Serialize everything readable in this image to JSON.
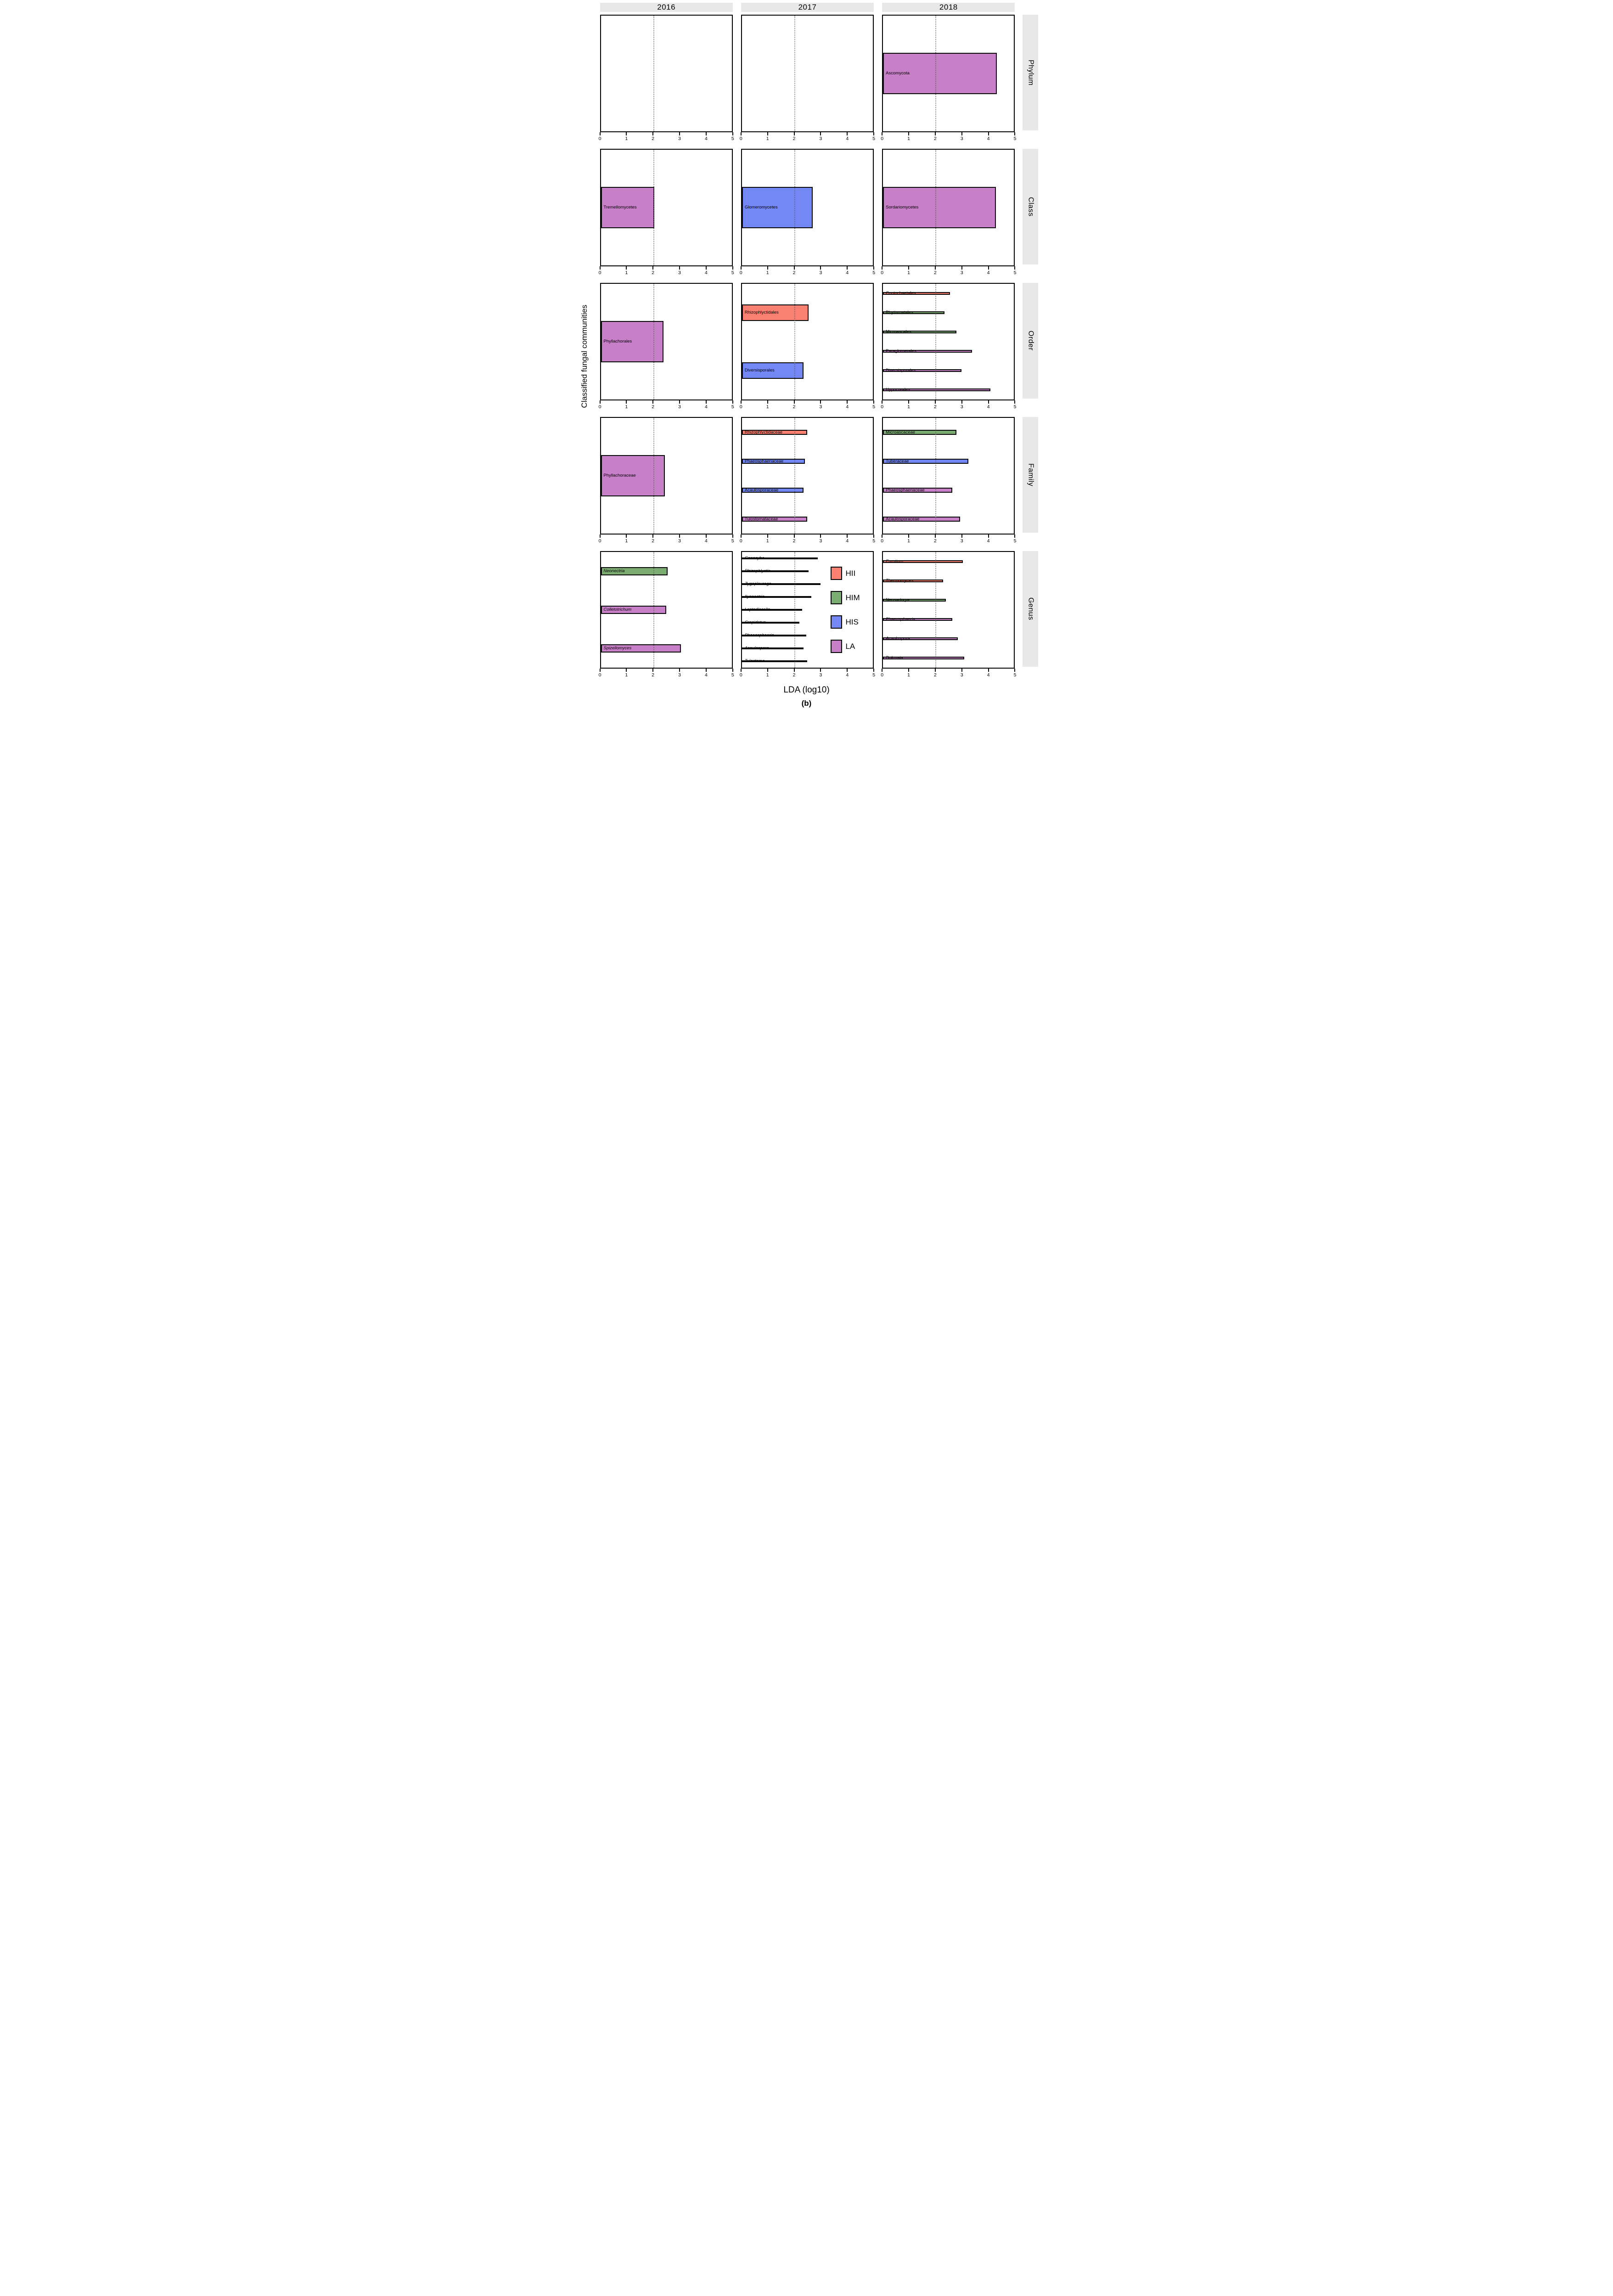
{
  "figure": {
    "xlabel": "LDA (log10)",
    "caption": "(b)",
    "ylabel": "Classified fungal communities"
  },
  "columns": [
    "2016",
    "2017",
    "2018"
  ],
  "rows": [
    "Phylum",
    "Class",
    "Order",
    "Family",
    "Genus"
  ],
  "legend": {
    "items": [
      {
        "label": "HII",
        "color": "#FA8072"
      },
      {
        "label": "HIM",
        "color": "#7BAC72"
      },
      {
        "label": "HIS",
        "color": "#7388F5"
      },
      {
        "label": "LA",
        "color": "#C77FC7"
      }
    ]
  },
  "group_colors": {
    "HII": "#FA8072",
    "HIM": "#7BAC72",
    "HIS": "#7388F5",
    "LA": "#C77FC7"
  },
  "chart_data": {
    "type": "bar",
    "orientation": "horizontal",
    "title": "",
    "xlabel": "LDA (log10)",
    "ylabel": "Classified fungal communities",
    "xlim": [
      0,
      5
    ],
    "xticks": [
      0,
      1,
      2,
      3,
      4,
      5
    ],
    "reference_line_x": 2,
    "grid": "dotted reference line at x=2 only",
    "legend_position": "inside Genus-2017 panel, right side",
    "facet_columns": [
      "2016",
      "2017",
      "2018"
    ],
    "facet_rows": [
      "Phylum",
      "Class",
      "Order",
      "Family",
      "Genus"
    ],
    "cells": [
      [
        [],
        [],
        [
          {
            "label": "Ascomycota",
            "group": "LA",
            "value": 4.35
          }
        ]
      ],
      [
        [
          {
            "label": "Tremellomycetes",
            "group": "LA",
            "value": 2.05
          }
        ],
        [
          {
            "label": "Glomeromycetes",
            "group": "HIS",
            "value": 2.7
          }
        ],
        [
          {
            "label": "Sordariomycetes",
            "group": "LA",
            "value": 4.3
          }
        ]
      ],
      [
        [
          {
            "label": "Phyllachorales",
            "group": "LA",
            "value": 2.4
          }
        ],
        [
          {
            "label": "Rhizophlyctidales",
            "group": "HII",
            "value": 2.55
          },
          {
            "label": "Diversisporales",
            "group": "HIS",
            "value": 2.35
          }
        ],
        [
          {
            "label": "Coniochaetales",
            "group": "HII",
            "value": 2.55
          },
          {
            "label": "Rhytismatales",
            "group": "HIM",
            "value": 2.35
          },
          {
            "label": "Microascales",
            "group": "HIM",
            "value": 2.8
          },
          {
            "label": "Paraglomerales",
            "group": "LA",
            "value": 3.4
          },
          {
            "label": "Diversisporales",
            "group": "LA",
            "value": 3.0
          },
          {
            "label": "Hypocreales",
            "group": "LA",
            "value": 4.1
          }
        ]
      ],
      [
        [
          {
            "label": "Phyllachoraceae",
            "group": "LA",
            "value": 2.45
          }
        ],
        [
          {
            "label": "Rhizophlyctidaceae",
            "group": "HII",
            "value": 2.5
          },
          {
            "label": "Phaeosphaeriaceae",
            "group": "HIS",
            "value": 2.4
          },
          {
            "label": "Acaulosporaceae",
            "group": "HIS",
            "value": 2.35
          },
          {
            "label": "Tulostomataceae",
            "group": "LA",
            "value": 2.5
          }
        ],
        [
          {
            "label": "Microascaceae",
            "group": "HIM",
            "value": 2.8
          },
          {
            "label": "Tuberaceae",
            "group": "HIS",
            "value": 3.25
          },
          {
            "label": "Phaeosphaeriaceae",
            "group": "LA",
            "value": 2.65
          },
          {
            "label": "Acaulosporaceae",
            "group": "LA",
            "value": 2.95
          }
        ]
      ],
      [
        [
          {
            "label": "Neonectria",
            "group": "HIM",
            "value": 2.55
          },
          {
            "label": "Colletotrichum",
            "group": "LA",
            "value": 2.5
          },
          {
            "label": "Spizellomyces",
            "group": "LA",
            "value": 3.05
          }
        ],
        [
          {
            "label": "Conocybe",
            "group": "HII",
            "value": 2.9
          },
          {
            "label": "Rhizophlyctis",
            "group": "HII",
            "value": 2.55
          },
          {
            "label": "Zygopleurage",
            "group": "HII",
            "value": 3.0
          },
          {
            "label": "Ilyonectria",
            "group": "HIM",
            "value": 2.65
          },
          {
            "label": "Leptodiscella",
            "group": "HIM",
            "value": 2.3
          },
          {
            "label": "Crepidotus",
            "group": "HIM",
            "value": 2.2
          },
          {
            "label": "Phaeosphaeria",
            "group": "HIS",
            "value": 2.45
          },
          {
            "label": "Acaulospora",
            "group": "HIS",
            "value": 2.35
          },
          {
            "label": "Tulostoma",
            "group": "LA",
            "value": 2.5
          }
        ],
        [
          {
            "label": "Eurotium",
            "group": "HII",
            "value": 3.05
          },
          {
            "label": "Thermomyces",
            "group": "HII",
            "value": 2.3
          },
          {
            "label": "Neosartorya",
            "group": "HIM",
            "value": 2.4
          },
          {
            "label": "Phaeosphaeria",
            "group": "LA",
            "value": 2.65
          },
          {
            "label": "Acaulospora",
            "group": "LA",
            "value": 2.85
          },
          {
            "label": "Dokmaia",
            "group": "LA",
            "value": 3.1
          }
        ]
      ]
    ]
  }
}
